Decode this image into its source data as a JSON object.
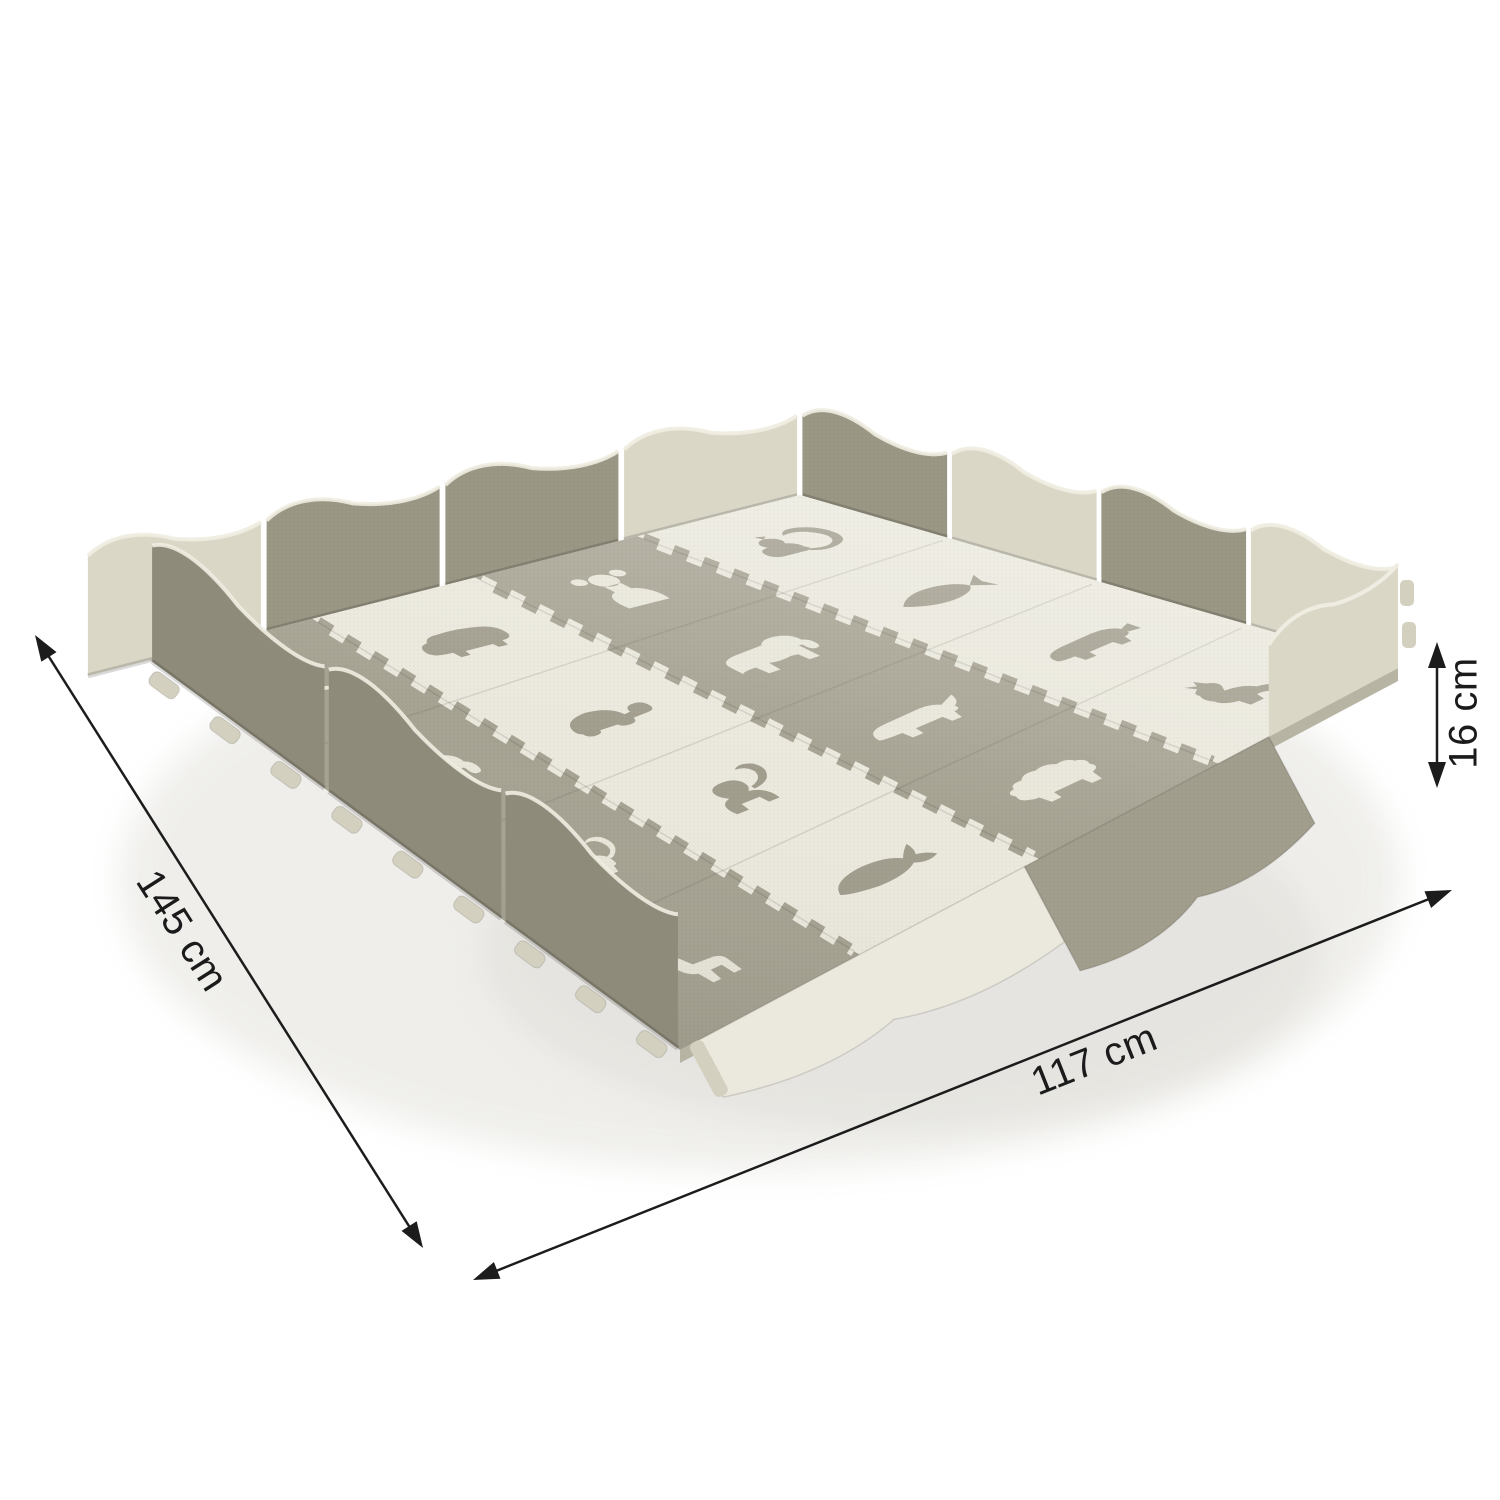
{
  "dimensions": {
    "depth": {
      "label": "145 cm"
    },
    "width": {
      "label": "117 cm"
    },
    "height": {
      "label": "16 cm"
    }
  },
  "mat": {
    "grid": {
      "rows": 4,
      "cols": 4
    },
    "colors": {
      "background": "#ffffff",
      "tile_gray": "#a7a393",
      "tile_cream": "#ebe9dd",
      "animal_on_gray": "#e9e7da",
      "animal_on_cream": "#a29e8e",
      "wall_dark": "#9b9785",
      "wall_cream": "#dad7c7",
      "wall_front": "#8f8b7b",
      "edge_highlight": "#efede1",
      "edge_side": "#b7b4a3",
      "tab": "#d3d0bf",
      "dimension_line": "#1c1c1c"
    },
    "tiles": [
      {
        "row": 0,
        "col": 0,
        "base": "gray",
        "animal": "bird"
      },
      {
        "row": 0,
        "col": 1,
        "base": "cream",
        "animal": "hippo"
      },
      {
        "row": 0,
        "col": 2,
        "base": "gray",
        "animal": "bear"
      },
      {
        "row": 0,
        "col": 3,
        "base": "cream",
        "animal": "squirrel"
      },
      {
        "row": 1,
        "col": 0,
        "base": "gray",
        "animal": "elephant"
      },
      {
        "row": 1,
        "col": 1,
        "base": "cream",
        "animal": "turtle"
      },
      {
        "row": 1,
        "col": 2,
        "base": "gray",
        "animal": "elephant"
      },
      {
        "row": 1,
        "col": 3,
        "base": "cream",
        "animal": "fish"
      },
      {
        "row": 2,
        "col": 0,
        "base": "gray",
        "animal": "cat"
      },
      {
        "row": 2,
        "col": 1,
        "base": "cream",
        "animal": "monkey"
      },
      {
        "row": 2,
        "col": 2,
        "base": "gray",
        "animal": "rhino"
      },
      {
        "row": 2,
        "col": 3,
        "base": "cream",
        "animal": "pig"
      },
      {
        "row": 3,
        "col": 0,
        "base": "gray",
        "animal": "giraffe"
      },
      {
        "row": 3,
        "col": 1,
        "base": "cream",
        "animal": "whale"
      },
      {
        "row": 3,
        "col": 2,
        "base": "gray",
        "animal": "sheep"
      },
      {
        "row": 3,
        "col": 3,
        "base": "cream",
        "animal": "kangaroo"
      }
    ]
  }
}
